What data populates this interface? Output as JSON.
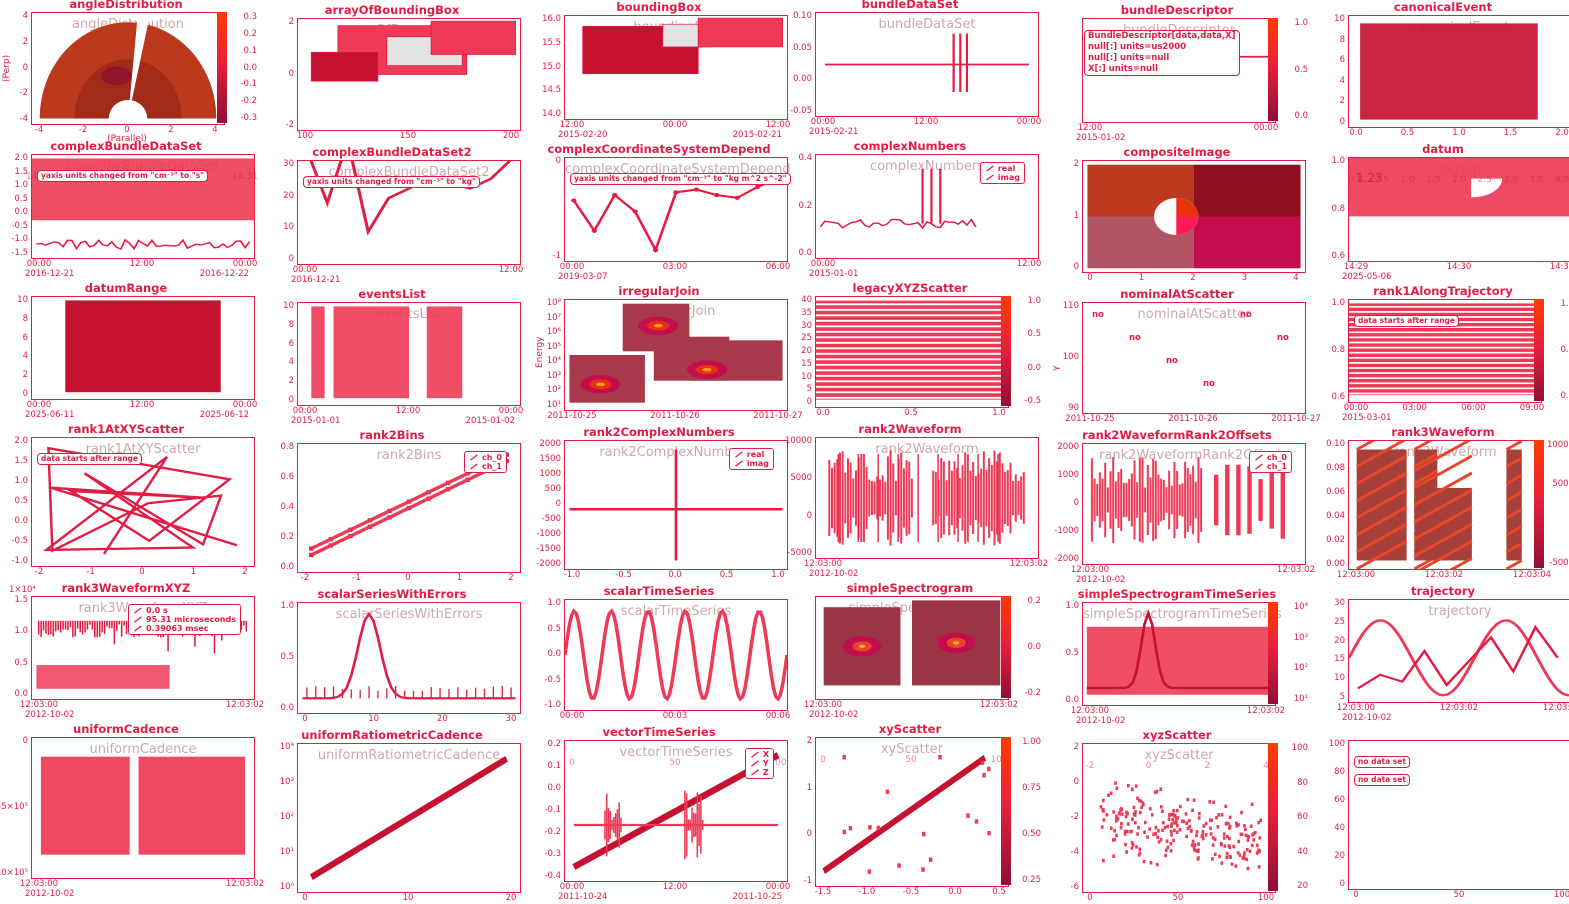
{
  "page": {
    "kind": "plot-gallery-screenshot",
    "width": 1569,
    "height": 904
  },
  "colors": {
    "accent": "#e31c45",
    "fill": "#ee3a56",
    "fill_dark": "#c51230",
    "fill_light": "#f4556d",
    "gray_box": "#e3e3e3",
    "maroon": "#9a3545",
    "heat_orange": "#bb3a1e",
    "heat_dark": "#8f0f2f",
    "magenta": "#c40d4e",
    "ghost": "rgba(160,95,105,0.55)",
    "cbar_gradient_top": "#ff3c00",
    "cbar_gradient_mid": "#e8203a",
    "cbar_gradient_bottom": "#8f0f38"
  },
  "chart_data": [
    {
      "name": "angleDistribution",
      "type": "heatmap",
      "kind": "polarHeat",
      "title": "angleDistribution",
      "xlabel": "(Parallel)",
      "ylabel": "(Perp)",
      "xticks": [
        -4,
        -2,
        0,
        2,
        4
      ],
      "yticks": [
        4,
        2,
        0,
        -2,
        -4
      ],
      "colorbar": [
        "0.3",
        "0.2",
        "0.1",
        "0.0",
        "-0.1",
        "-0.2",
        "-0.3"
      ],
      "description": "polar half-disk angular distribution heatmap with white wedge gap"
    },
    {
      "name": "arrayOfBoundingBox",
      "type": "area",
      "kind": "boxes",
      "title": "arrayOfBoundingBox",
      "xticks": [
        100,
        150,
        200
      ],
      "yticks": [
        2,
        0,
        -2
      ],
      "boxes": [
        [
          18,
          6,
          58,
          44,
          "fill"
        ],
        [
          40,
          16,
          34,
          26,
          "gray"
        ],
        [
          6,
          30,
          30,
          26,
          "dark"
        ],
        [
          60,
          2,
          38,
          30,
          "fill"
        ]
      ]
    },
    {
      "name": "boundingBox",
      "type": "area",
      "kind": "boxes",
      "title": "boundingBox",
      "xticks": [
        "12:00",
        "00:00",
        "12:00"
      ],
      "xdates": [
        "2015-02-20",
        "2015-02-21"
      ],
      "yticks": [
        "16.0",
        "15.5",
        "15.0",
        "14.5",
        "14.0"
      ],
      "boxes": [
        [
          8,
          10,
          52,
          46,
          "dark"
        ],
        [
          44,
          8,
          22,
          22,
          "gray"
        ],
        [
          60,
          2,
          38,
          28,
          "fill"
        ]
      ]
    },
    {
      "name": "bundleDataSet",
      "type": "line",
      "kind": "spikeLine",
      "title": "bundleDataSet",
      "xticks": [
        "00:00",
        "12:00",
        "00:00"
      ],
      "xdates": [
        "2015-02-21"
      ],
      "yticks": [
        "0.10",
        "0.05",
        "0.00",
        "-0.05"
      ],
      "description": "flat line at 0.00 with narrow spike pair near right"
    },
    {
      "name": "bundleDescriptor",
      "type": "table",
      "kind": "descriptor",
      "title": "bundleDescriptor",
      "box_lines": [
        "BundleDescriptor[data,data,X]",
        "null[:] units=us2000",
        "null[:] units=null",
        "X[:] units=null"
      ],
      "xticks": [
        "12:00",
        "00:00"
      ],
      "xdates": [
        "2015-01-02"
      ],
      "colorbar": [
        "1.0",
        "0.5",
        "0.0"
      ]
    },
    {
      "name": "canonicalEvent",
      "type": "bar",
      "kind": "eventBar",
      "title": "canonicalEvent",
      "xticks": [
        "0.0",
        "0.5",
        "1.0",
        "1.5",
        "2.0"
      ],
      "yticks": [
        10,
        8,
        6,
        4,
        2,
        0
      ],
      "event": {
        "start": 0.1,
        "end": 1.7,
        "y0": 0,
        "y1": 10
      }
    },
    {
      "name": "complexBundleDataSet",
      "type": "area",
      "kind": "bandAnnot",
      "title": "complexBundleDataSet",
      "annotations": [
        "yaxis units changed from \"cm⁻³\" to \"s\""
      ],
      "xticks": [
        "00:00",
        "12:00",
        "00:00"
      ],
      "xdates": [
        "2016-12-21",
        "2016-12-22"
      ],
      "ghost_xticks": [
        "14:29",
        "14:30",
        "14:31"
      ],
      "yticks": [
        "2.0",
        "1.5",
        "1.0",
        "0.5",
        "0.0",
        "-0.5",
        "-1.0",
        "-1.5"
      ]
    },
    {
      "name": "complexBundleDataSet2",
      "type": "line",
      "kind": "zigzag",
      "title": "complexBundleDataSet2",
      "annotations": [
        "yaxis units changed from \"cm⁻³\" to \"kg\""
      ],
      "xticks": [
        "00:00",
        "12:00"
      ],
      "xdates": [
        "2016-12-21"
      ],
      "yticks": [
        30,
        20,
        10,
        0
      ],
      "points": [
        26,
        4,
        30,
        -8,
        6,
        10,
        14,
        12,
        10,
        14,
        22
      ]
    },
    {
      "name": "complexCoordinateSystemDependent",
      "type": "line",
      "kind": "zigzagMark",
      "title": "complexCoordinateSystemDepend",
      "annotations": [
        "yaxis units changed from \"cm⁻³\" to \"kg m^2 s^-2\""
      ],
      "xticks": [
        "00:00",
        "03:00",
        "06:00"
      ],
      "xdates": [
        "2019-03-07"
      ],
      "yticks": [
        "0",
        "-1"
      ],
      "points": [
        0.2,
        -0.9,
        0.4,
        -0.2,
        -1.6,
        0.5,
        0.6,
        0.4,
        0.3,
        0.7,
        1.0
      ]
    },
    {
      "name": "complexNumbers",
      "type": "line",
      "kind": "noisyLine",
      "title": "complexNumbers",
      "legend": [
        "real",
        "imag"
      ],
      "xticks": [
        "00:00",
        "12:00"
      ],
      "xdates": [
        "2015-01-01"
      ],
      "yticks": [
        "0.4",
        "0.2",
        "0.0"
      ],
      "description": "noisy flat real/imag traces with three tall spikes"
    },
    {
      "name": "compositeImage",
      "type": "heatmap",
      "kind": "quadrant",
      "title": "compositeImage",
      "xticks": [
        0,
        1,
        2,
        3,
        4
      ],
      "yticks": [
        2,
        1,
        0
      ],
      "description": "2x2 quadrant image (orange-red, dark red, rose, magenta) with white ellipse"
    },
    {
      "name": "datum",
      "type": "area",
      "kind": "pieBand",
      "title": "datum",
      "value_label": "1.23",
      "xticks": [
        "14:29",
        "14:30",
        "14:31"
      ],
      "xdates": [
        "2025-05-06"
      ],
      "yticks": [
        "1.0",
        "0.8",
        "0.6"
      ],
      "ghost_xticks": [
        "0.0",
        "0.5",
        "1.0",
        "1.5",
        "2.0",
        "2.5",
        "3.0",
        "3.5",
        "4.0"
      ]
    },
    {
      "name": "datumRange",
      "type": "bar",
      "kind": "solidRect",
      "title": "datumRange",
      "xticks": [
        "00:00",
        "12:00",
        "00:00"
      ],
      "xdates": [
        "2025-06-11",
        "2025-06-12"
      ],
      "yticks": [
        10,
        8,
        6,
        4,
        2,
        0
      ],
      "event": {
        "start": 0.15,
        "end": 0.85
      }
    },
    {
      "name": "eventsList",
      "type": "bar",
      "kind": "bands",
      "title": "eventsList",
      "xticks": [
        "00:00",
        "12:00",
        "00:00"
      ],
      "xdates": [
        "2015-01-01",
        "2015-01-02"
      ],
      "yticks": [
        10,
        8,
        6,
        4,
        2,
        0
      ],
      "bands": [
        [
          6,
          6
        ],
        [
          16,
          34
        ],
        [
          58,
          16
        ]
      ]
    },
    {
      "name": "irregularJoin",
      "type": "heatmap",
      "kind": "blobHeat",
      "title": "irregularJoin",
      "ylabel": "Energy",
      "yticks": [
        "10⁸",
        "10⁷",
        "10⁶",
        "10⁵",
        "10⁴",
        "10³",
        "10²",
        "10¹"
      ],
      "xticks": [
        "2011-10-25",
        "2011-10-26",
        "2011-10-27"
      ],
      "colorbar": [],
      "description": "staircase heatmap tiles with hot elliptical blobs"
    },
    {
      "name": "legacyXYZScatter",
      "type": "heatmap",
      "kind": "striped",
      "title": "legacyXYZScatter",
      "xticks": [
        "0.0",
        "0.5",
        "1.0"
      ],
      "yticks": [
        40,
        35,
        30,
        25,
        20,
        15,
        10,
        5,
        0
      ],
      "colorbar": [
        "1.0",
        "0.5",
        "0.0",
        "-0.5"
      ]
    },
    {
      "name": "nominalAtScatter",
      "type": "scatter",
      "kind": "nominal",
      "title": "nominalAtScatter",
      "ylabel": "Y",
      "labels": [
        "no",
        "no",
        "no",
        "no",
        "no",
        "no"
      ],
      "xticks": [
        "2011-10-25",
        "2011-10-26",
        "2011-10-27"
      ],
      "yticks": [
        110,
        100,
        90
      ]
    },
    {
      "name": "rank1AlongTrajectory",
      "type": "heatmap",
      "kind": "stripedAnnot",
      "title": "rank1AlongTrajectory",
      "annotations": [
        "data starts after range"
      ],
      "xticks": [
        "00:00",
        "03:00",
        "06:00",
        "09:00"
      ],
      "xdates": [
        "2015-03-01"
      ],
      "yticks": [
        "1.0",
        "0.8",
        "0.6"
      ],
      "colorbar": [
        "1.0",
        "0.5",
        "0.0"
      ]
    },
    {
      "name": "rank1AtXYScatter",
      "type": "line",
      "kind": "tangle",
      "title": "rank1AtXYScatter",
      "annotations": [
        "data starts after range"
      ],
      "xticks": [
        -2,
        -1,
        0,
        1,
        2
      ],
      "yticks": [
        "2.0",
        "1.5",
        "1.0",
        "0.5",
        "0.0",
        "-0.5",
        "-1.0"
      ],
      "description": "tangled connected xy scatter web"
    },
    {
      "name": "rank2Bins",
      "type": "line",
      "kind": "markerLine",
      "title": "rank2Bins",
      "legend": [
        "ch_0",
        "ch_1"
      ],
      "xticks": [
        -2,
        -1,
        0,
        1,
        2
      ],
      "yticks": [
        "0.8",
        "0.6",
        "0.4",
        "0.2",
        "0.0"
      ],
      "series": [
        {
          "name": "ch_0",
          "x": [
            -2,
            -1,
            0,
            1,
            2
          ],
          "y": [
            0.05,
            0.22,
            0.42,
            0.62,
            0.82
          ]
        },
        {
          "name": "ch_1",
          "x": [
            -2,
            -1,
            0,
            1,
            2
          ],
          "y": [
            0.0,
            0.18,
            0.38,
            0.58,
            0.78
          ]
        }
      ]
    },
    {
      "name": "rank2ComplexNumbers",
      "type": "line",
      "kind": "cross",
      "title": "rank2ComplexNumbers",
      "legend": [
        "real",
        "imag"
      ],
      "xticks": [
        "-1.0",
        "-0.5",
        "0.0",
        "0.5",
        "1.0"
      ],
      "yticks": [
        2000,
        1500,
        1000,
        500,
        0,
        -500,
        -1000,
        -1500,
        -2000
      ],
      "description": "flat real/imag traces with tall spike at x=0"
    },
    {
      "name": "rank2Waveform",
      "type": "line",
      "kind": "waveform",
      "title": "rank2Waveform",
      "xticks": [
        "12:03:00",
        "12:03:02"
      ],
      "xdates": [
        "2012-10-02"
      ],
      "yticks": [
        10000,
        5000,
        0,
        -5000
      ],
      "description": "dense two-burst waveform with centre gap"
    },
    {
      "name": "rank2WaveformRank2Offsets",
      "type": "line",
      "kind": "waveformGaps",
      "title": "rank2WaveformRank2Offsets",
      "legend": [
        "ch_0",
        "ch_1"
      ],
      "xticks": [
        "12:03:00",
        "12:03:02"
      ],
      "xdates": [
        "2012-10-02"
      ],
      "yticks": [
        2000,
        1000,
        0,
        -1000,
        -2000
      ],
      "description": "dense waveform burst then sparse vertical packets"
    },
    {
      "name": "rank3Waveform",
      "type": "heatmap",
      "kind": "hatch",
      "title": "rank3Waveform",
      "xticks": [
        "12:03:00",
        "12:03:02",
        "12:03:04"
      ],
      "yticks": [
        "0.10",
        "0.08",
        "0.06",
        "0.04",
        "0.02",
        "0.00"
      ],
      "colorbar": [
        10000,
        5000,
        0,
        -5000
      ],
      "description": "three diagonally striped spectrogram blocks"
    },
    {
      "name": "rank3WaveformXYZ",
      "type": "line",
      "kind": "spikes",
      "title": "rank3WaveformXYZ",
      "legend": [
        "0.0 s",
        "95.31 microseconds",
        "0.39063 msec"
      ],
      "offset_text": "1×10⁴",
      "xticks": [
        "12:03:00",
        "12:03:02"
      ],
      "xdates": [
        "2012-10-02"
      ],
      "yticks": [
        "1.5",
        "1.0",
        "0.5",
        "0.0"
      ],
      "description": "dense spike train for three offset channels"
    },
    {
      "name": "scalarSeriesWithErrors",
      "type": "line",
      "kind": "bell",
      "title": "scalarSeriesWithErrors",
      "xticks": [
        0,
        10,
        20,
        30
      ],
      "yticks": [
        "1.0",
        "0.5",
        "0.0"
      ],
      "description": "gaussian peak near x=10 with error whiskers along baseline"
    },
    {
      "name": "scalarTimeSeries",
      "type": "line",
      "kind": "sine",
      "title": "scalarTimeSeries",
      "xticks": [
        "00:00",
        "00:03",
        "00:06"
      ],
      "yticks": [
        "1.0",
        "0.5",
        "0.0",
        "-0.5",
        "-1.0"
      ],
      "wave": {
        "cycles": 6,
        "amplitude": 1
      }
    },
    {
      "name": "simpleSpectrogram",
      "type": "heatmap",
      "kind": "spec2",
      "title": "simpleSpectrogram",
      "xticks": [
        "12:03:00",
        "12:03:02"
      ],
      "xdates": [
        "2012-10-02"
      ],
      "colorbar": [
        "0.2",
        "0.0",
        "-0.2"
      ],
      "description": "two maroon spectrogram panels with concentric hot blobs"
    },
    {
      "name": "simpleSpectrogramTimeSeries",
      "type": "heatmap",
      "kind": "spec1",
      "title": "simpleSpectrogramTimeSeries",
      "xticks": [
        "12:03:00",
        "12:03:02"
      ],
      "xdates": [
        "2012-10-02"
      ],
      "yticks": [
        "1.0",
        "0.5",
        "0.0"
      ],
      "colorbar": [
        "10⁴",
        "10³",
        "10²",
        "10¹"
      ],
      "description": "spectrogram band with overlaid gaussian peak trace"
    },
    {
      "name": "trajectory",
      "type": "line",
      "kind": "traj",
      "title": "trajectory",
      "xticks": [
        "12:03:00",
        "12:03:02",
        "12:03:04"
      ],
      "xdates": [
        "2012-10-02"
      ],
      "yticks": [
        30,
        25,
        20,
        15,
        10,
        5
      ],
      "description": "sine orbit trace plus jagged descending polyline"
    },
    {
      "name": "uniformCadence",
      "type": "bar",
      "kind": "gapBand",
      "title": "uniformCadence",
      "xticks": [
        "12:03:00",
        "12:03:02"
      ],
      "xdates": [
        "2012-10-02"
      ],
      "yticks": [
        "0",
        "-5×10⁵",
        "-10×10⁵"
      ],
      "description": "filled cadence band with white dropout gap"
    },
    {
      "name": "uniformRatiometricCadence",
      "type": "line",
      "kind": "logLine",
      "title": "uniformRatiometricCadence",
      "xticks": [
        0,
        10,
        20
      ],
      "yticks": [
        "10⁴",
        "10³",
        "10²",
        "10¹",
        "10⁰"
      ],
      "description": "straight ascending line on log y axis"
    },
    {
      "name": "vectorTimeSeries",
      "type": "line",
      "kind": "vector",
      "title": "vectorTimeSeries",
      "legend": [
        "X",
        "Y",
        "Z"
      ],
      "xticks": [
        "00:00",
        "12:00",
        "00:00"
      ],
      "xdates": [
        "2011-10-24",
        "2011-10-25"
      ],
      "ghost_xticks": [
        "0",
        "50",
        "100"
      ],
      "yticks": [
        "0.2",
        "0.1",
        "0.0",
        "-0.1",
        "-0.2",
        "-0.3",
        "-0.4"
      ],
      "description": "thick ascending ramp plus flat trace with two burst glitches"
    },
    {
      "name": "xyScatter",
      "type": "scatter",
      "kind": "scatterLine",
      "title": "xyScatter",
      "xticks": [
        "-1.5",
        "-1.0",
        "-0.5",
        "0.0",
        "0.5"
      ],
      "yticks": [
        2,
        1,
        0,
        -1
      ],
      "ghost_xticks": [
        "0",
        "50",
        "100"
      ],
      "colorbar": [
        "1.00",
        "0.75",
        "0.50",
        "0.25"
      ],
      "description": "thick diagonal ramp with sparse square scatter points"
    },
    {
      "name": "xyzScatter",
      "type": "scatter",
      "kind": "cloud",
      "title": "xyzScatter",
      "xticks": [
        0,
        50,
        100
      ],
      "yticks": [
        2,
        0,
        -2,
        -4,
        -6
      ],
      "ghost_xticks": [
        "-2",
        "0",
        "2",
        "4"
      ],
      "colorbar": [
        100,
        80,
        60,
        40,
        20
      ],
      "description": "dense color-mapped scatter cloud, slight negative trend"
    },
    {
      "name": "empty-cell",
      "type": "scatter",
      "kind": "empty",
      "title": "",
      "annotations": [
        "no data set",
        "no data set"
      ],
      "xticks": [
        0,
        50,
        100
      ],
      "yticks": [
        100,
        80,
        60,
        40,
        20,
        0
      ]
    }
  ]
}
